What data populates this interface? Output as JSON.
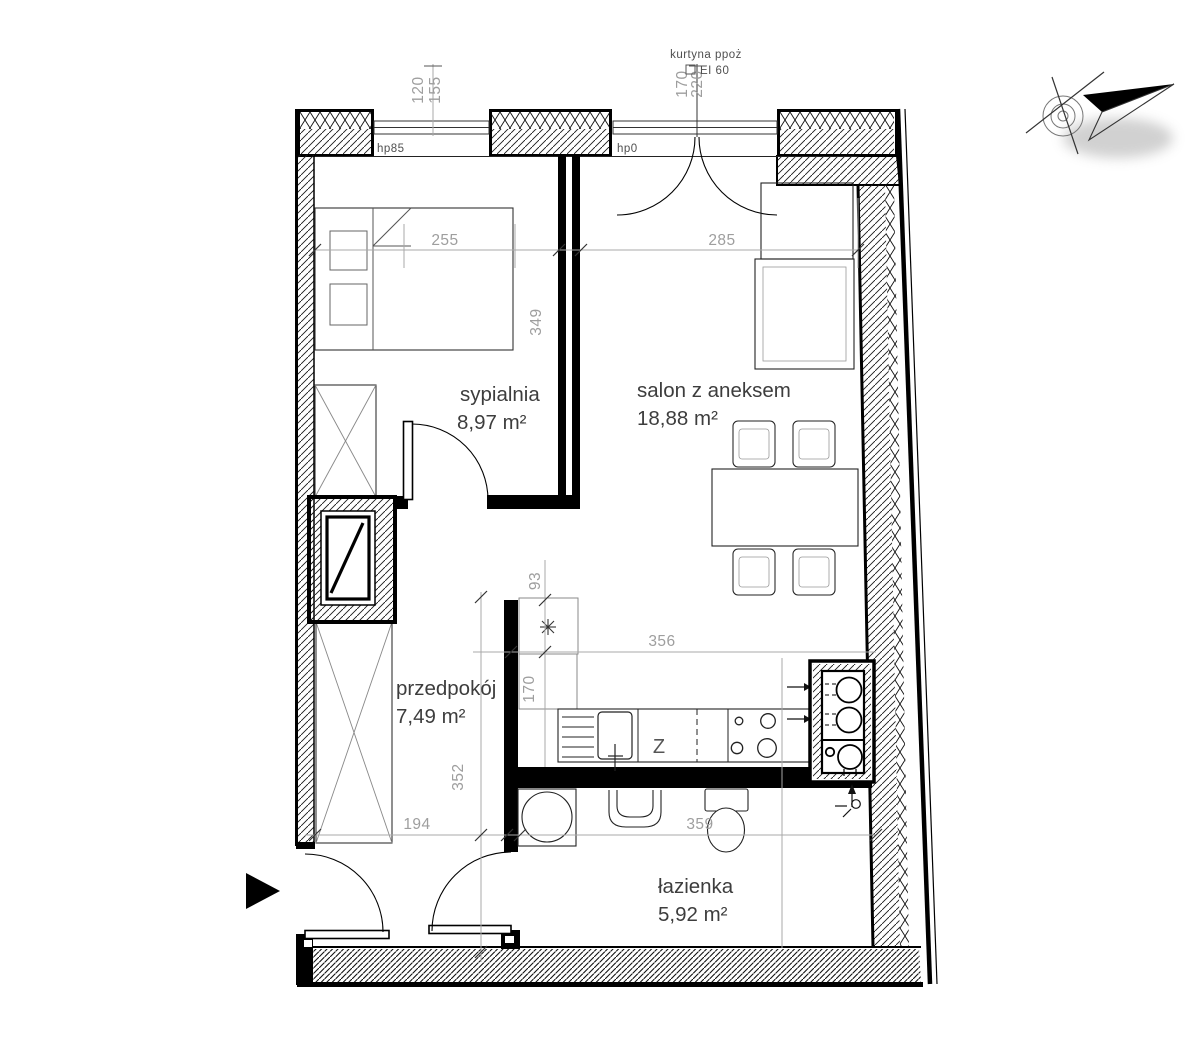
{
  "rooms": [
    {
      "name": "sypialnia",
      "area": "8,97 m²"
    },
    {
      "name": "salon z aneksem",
      "area": "18,88 m²"
    },
    {
      "name": "przedpokój",
      "area": "7,49 m²"
    },
    {
      "name": "łazienka",
      "area": "5,92 m²"
    }
  ],
  "annotations": {
    "fire_curtain": "kurtyna ppoż",
    "fire_rating": "EI 60",
    "sill_height_left_window": "hp85",
    "sill_height_balcony_door": "hp0",
    "kitchen_sink_label": "Z"
  },
  "dimensions": {
    "bedroom_width": "255",
    "living_width": "285",
    "bedroom_depth": "349",
    "kitchen_wall_run": "356",
    "kitchen_depth": "170",
    "kitchen_offset": "93",
    "hall_depth": "352",
    "hall_width": "194",
    "bathroom_width": "359",
    "left_window_a": "120",
    "left_window_b": "155",
    "curtain_a": "170",
    "curtain_b": "220"
  },
  "colors": {
    "wall": "#000000",
    "dim_text": "#9e9e9e",
    "room_label": "#3d3d3d",
    "annotation": "#4f4f4f"
  }
}
